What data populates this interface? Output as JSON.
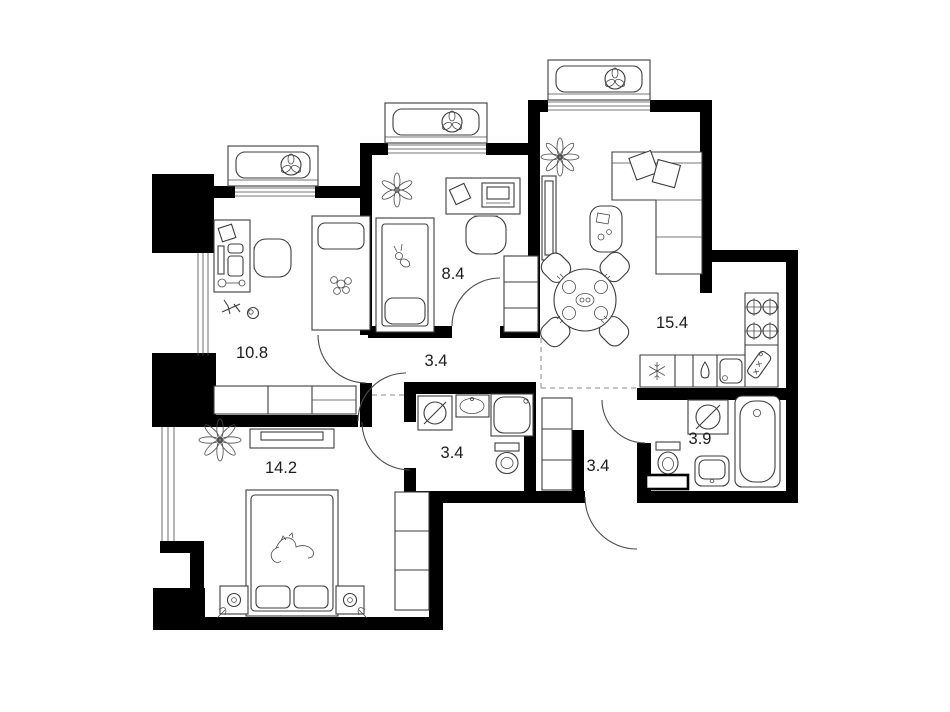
{
  "plan": {
    "background_color": "#ffffff",
    "wall_color": "#000000",
    "line_color": "#3c3c3c",
    "rooms": [
      {
        "name": "child-bedroom-1",
        "area": "10.8"
      },
      {
        "name": "child-bedroom-2",
        "area": "8.4"
      },
      {
        "name": "hall",
        "area": "3.4"
      },
      {
        "name": "kitchen-living-room",
        "area": "15.4"
      },
      {
        "name": "master-bedroom",
        "area": "14.2"
      },
      {
        "name": "bathroom",
        "area": "3.4"
      },
      {
        "name": "entry-corridor",
        "area": "3.4"
      },
      {
        "name": "bathroom-2",
        "area": "3.9"
      }
    ],
    "icons": [
      "fan-icon",
      "snowflake-fridge-icon",
      "water-drop-icon",
      "stove-burner-icon",
      "washing-machine-icon",
      "water-heater-icon",
      "plant-icon",
      "flower-icon",
      "toy-airplane-icon",
      "toy-ball-icon",
      "cat-sketch-icon",
      "rabbit-toy-icon",
      "cutting-board-icon",
      "lamp-icon"
    ]
  }
}
